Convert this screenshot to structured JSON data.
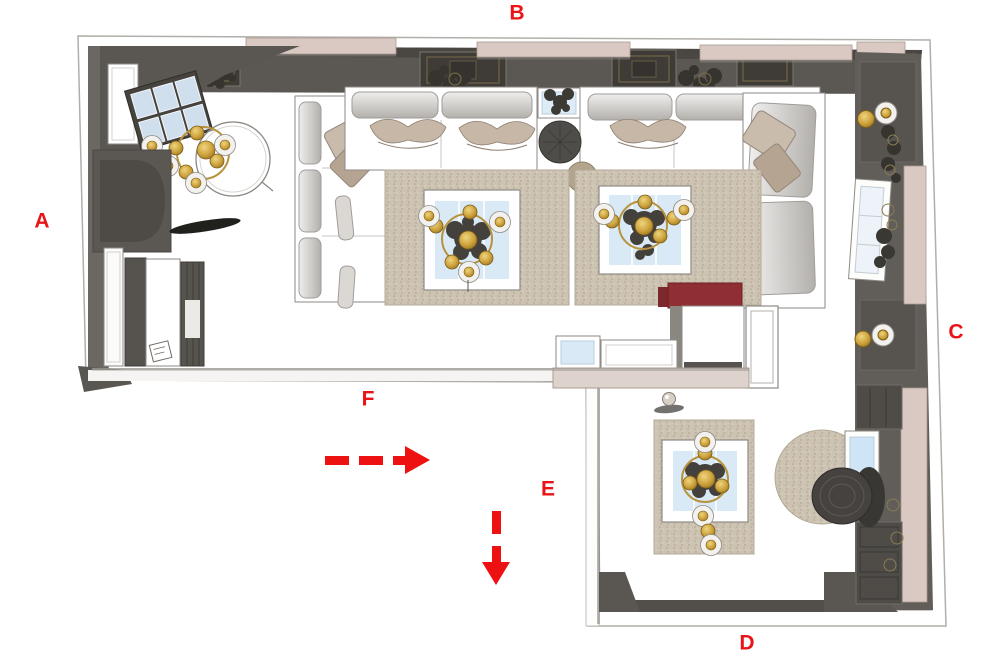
{
  "annotations": {
    "color": "#ea1418",
    "labels": [
      {
        "id": "A",
        "text": "A"
      },
      {
        "id": "B",
        "text": "B"
      },
      {
        "id": "C",
        "text": "C"
      },
      {
        "id": "D",
        "text": "D"
      },
      {
        "id": "E",
        "text": "E"
      },
      {
        "id": "F",
        "text": "F"
      }
    ],
    "arrows": [
      {
        "id": "arrow-right",
        "direction": "right",
        "style": "dashed",
        "color": "#ee1111"
      },
      {
        "id": "arrow-down",
        "direction": "down",
        "style": "dashed",
        "color": "#ee1111"
      }
    ]
  },
  "plan": {
    "colors": {
      "wall_gray": "#5b5753",
      "wall_light_gray": "#6b6763",
      "ceiling_coffer": "#3f3c38",
      "trim_beige": "#dac9c2",
      "rug_beige": "#cdc3b2",
      "glass_blue": "#d9eaf6",
      "gold_accent": "#c2952f",
      "armchair_red": "#8f2f33",
      "floor_white": "#ffffff"
    }
  }
}
